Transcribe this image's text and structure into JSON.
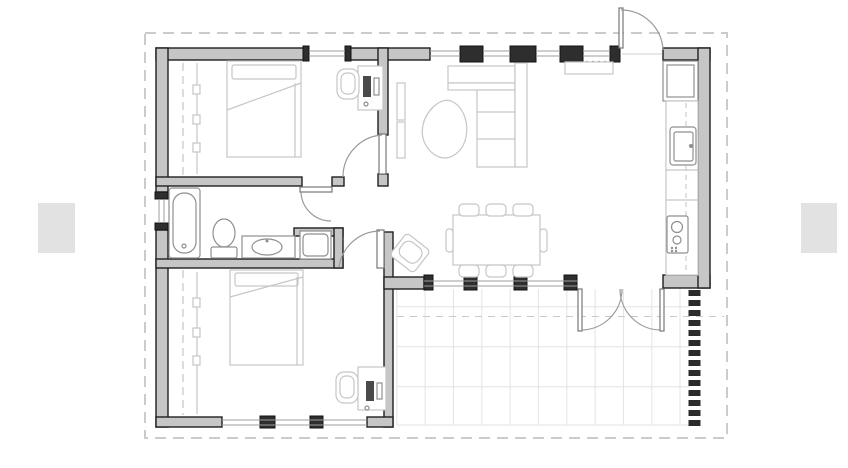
{
  "figure": {
    "kind": "architectural-floor-plan"
  },
  "colors": {
    "background": "#ffffff",
    "wall_fill": "#c6c6c6",
    "wall_outline": "#1f1f1f",
    "pier_fill": "#2e2e2e",
    "window_line": "#9c9c9c",
    "door_line": "#9a9a9a",
    "furniture_line": "#c6c6c6",
    "fixture_line": "#8f8f8f",
    "device_fill": "#4a4a4a",
    "grid_line": "#e3e3e3",
    "boundary_dash": "#cbcbcb",
    "deck_strip": "#2b2b2b",
    "placeholder_fill": "#e2e2e2"
  },
  "plan": {
    "rooms": [
      {
        "name": "bedroom-1"
      },
      {
        "name": "bathroom"
      },
      {
        "name": "bedroom-2"
      },
      {
        "name": "living-dining"
      },
      {
        "name": "kitchen"
      },
      {
        "name": "patio"
      }
    ],
    "doors": [
      "entry-door",
      "bedroom-1-door",
      "bedroom-2-door",
      "bathroom-door",
      "patio-french-door"
    ],
    "fixtures": [
      "bed",
      "wardrobe",
      "desk",
      "desk-chair",
      "bathtub",
      "toilet",
      "vanity-sink",
      "washing-machine",
      "sofa",
      "coffee-table",
      "tv-unit",
      "dining-table",
      "dining-chair",
      "armchair",
      "fridge",
      "kitchen-sink",
      "stove",
      "kitchen-counter"
    ]
  },
  "placeholders": {
    "left": {
      "side": "left"
    },
    "right": {
      "side": "right"
    }
  }
}
